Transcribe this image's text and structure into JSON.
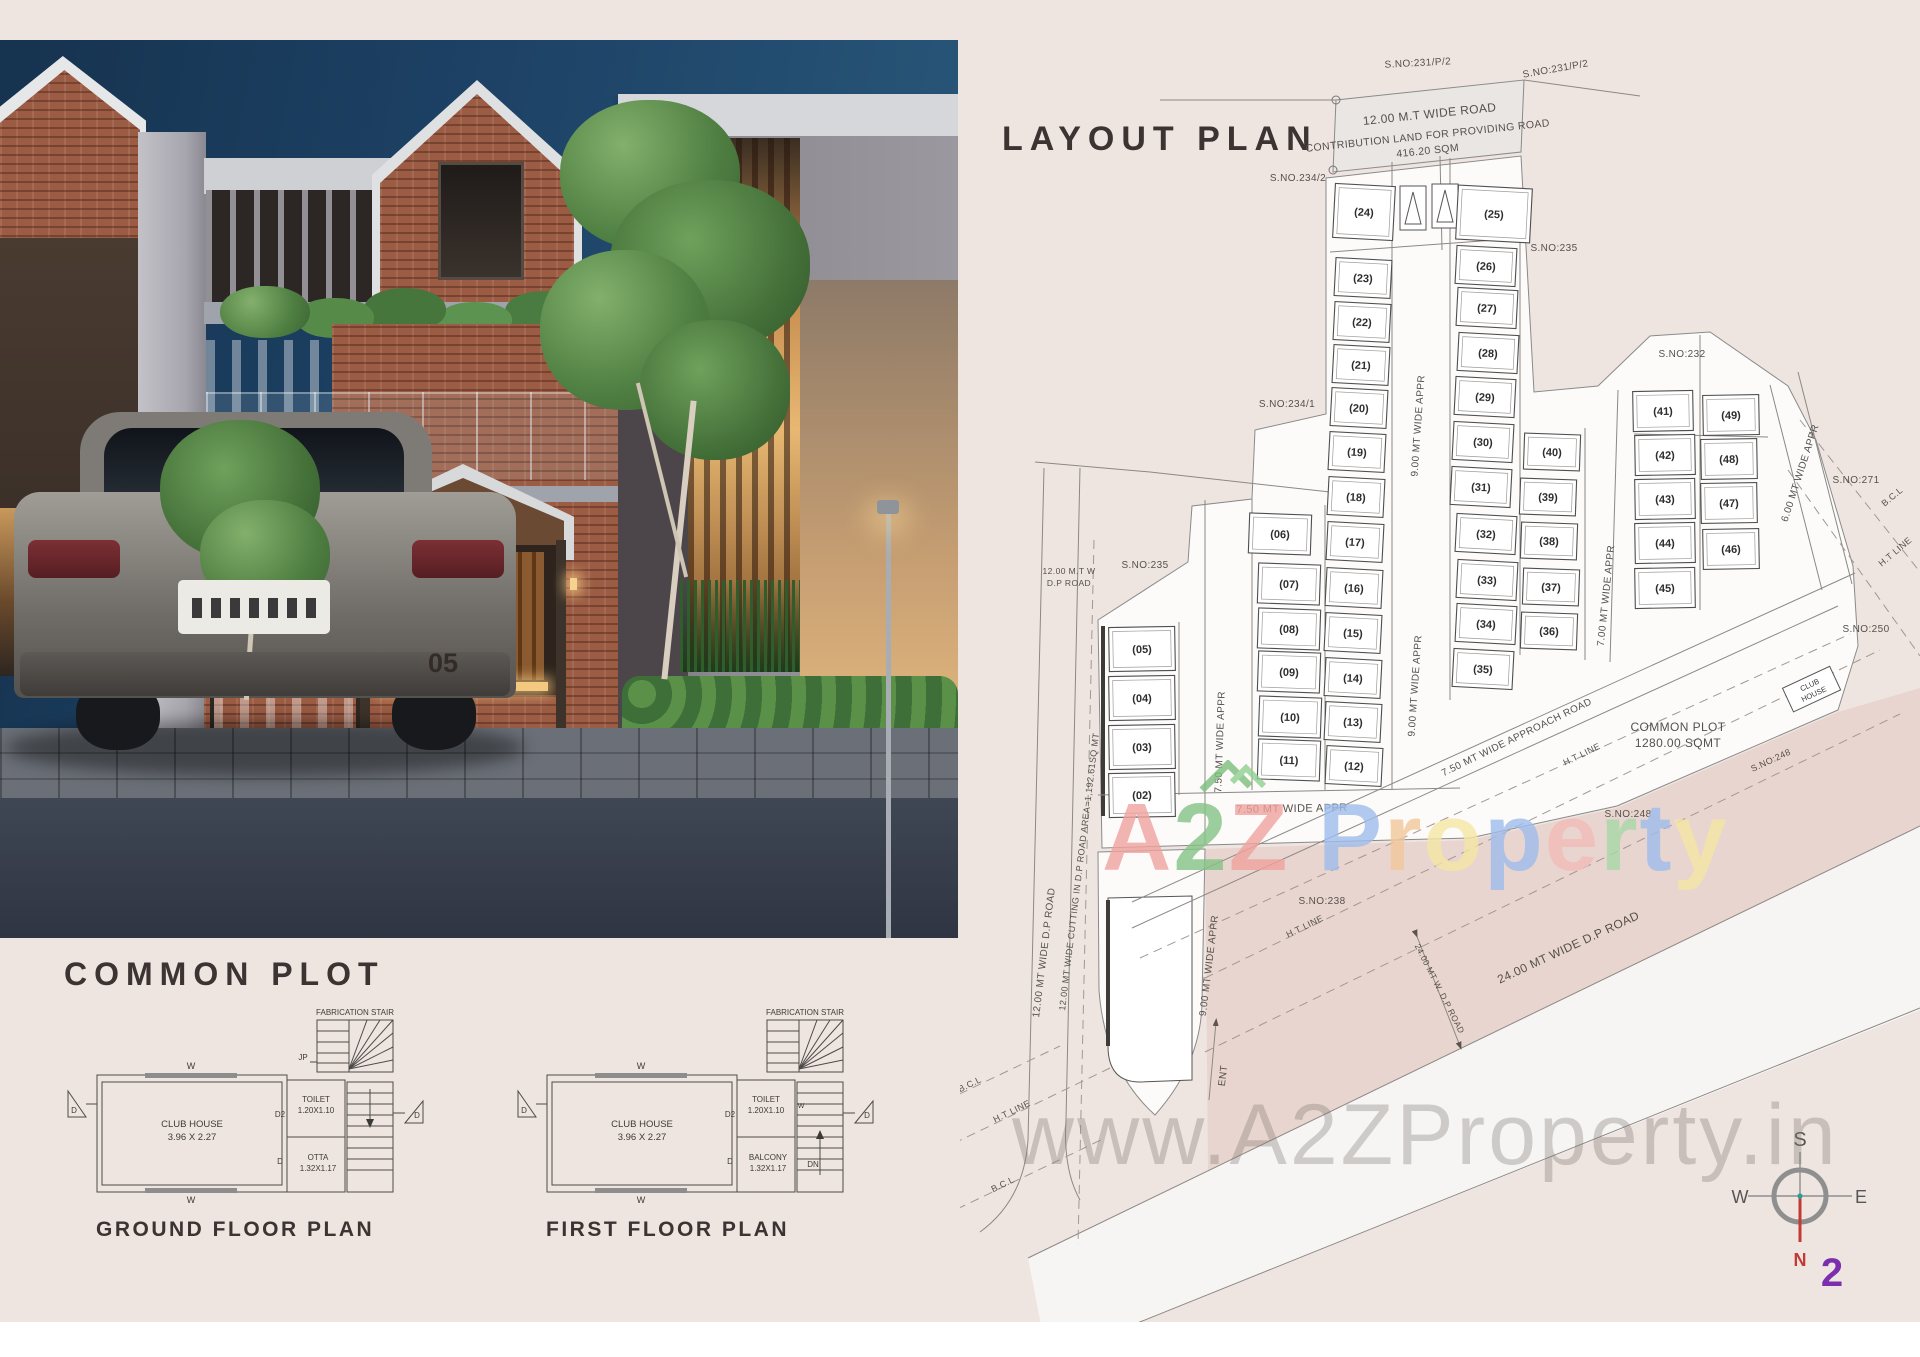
{
  "page": {
    "watermark_letters": [
      {
        "ch": "A",
        "color": "#f0a39e"
      },
      {
        "ch": "2",
        "color": "#85c487"
      },
      {
        "ch": "Z",
        "color": "#f0a39e"
      },
      {
        "ch": " ",
        "color": "#ffffff"
      },
      {
        "ch": "P",
        "color": "#9fbdec"
      },
      {
        "ch": "r",
        "color": "#f2c79b"
      },
      {
        "ch": "o",
        "color": "#f5e6a4"
      },
      {
        "ch": "p",
        "color": "#9fbdec"
      },
      {
        "ch": "e",
        "color": "#f2bdb8"
      },
      {
        "ch": "r",
        "color": "#a8d8a8"
      },
      {
        "ch": "t",
        "color": "#9fbdec"
      },
      {
        "ch": "y",
        "color": "#f5e6a4"
      }
    ],
    "watermark_url": "www.A2ZProperty.in"
  },
  "photo": {
    "house_number": "05"
  },
  "common_plot": {
    "title": "COMMON PLOT",
    "ground": {
      "caption": "GROUND FLOOR PLAN",
      "stair": "FABRICATION STAIR",
      "jp": "JP",
      "w": "W",
      "d": "D",
      "d2": "D2",
      "room": "CLUB HOUSE",
      "room_dim": "3.96 X 2.27",
      "toilet": "TOILET",
      "toilet_dim": "1.20X1.10",
      "aux": "OTTA",
      "aux_dim": "1.32X1.17"
    },
    "first": {
      "caption": "FIRST FLOOR PLAN",
      "stair": "FABRICATION STAIR",
      "w": "W",
      "w_side": "W",
      "d": "D",
      "d2": "D2",
      "room": "CLUB HOUSE",
      "room_dim": "3.96 X 2.27",
      "toilet": "TOILET",
      "toilet_dim": "1.20X1.10",
      "aux": "BALCONY",
      "aux_dim": "1.32X1.17",
      "dn": "DN"
    }
  },
  "layout_plan": {
    "title": "LAYOUT PLAN",
    "club_house_line1": "CLUB",
    "club_house_line2": "HOUSE",
    "compass": {
      "s": "S",
      "w": "W",
      "e": "E",
      "n": "N",
      "num": "2"
    },
    "plots": [
      {
        "n": "(02)",
        "x": 1142,
        "y": 795,
        "w": 66,
        "h": 44,
        "r": -1
      },
      {
        "n": "(03)",
        "x": 1142,
        "y": 747,
        "w": 66,
        "h": 44,
        "r": -1
      },
      {
        "n": "(04)",
        "x": 1142,
        "y": 698,
        "w": 66,
        "h": 44,
        "r": -1
      },
      {
        "n": "(05)",
        "x": 1142,
        "y": 649,
        "w": 66,
        "h": 44,
        "r": -1
      },
      {
        "n": "(06)",
        "x": 1280,
        "y": 534,
        "w": 62,
        "h": 40,
        "r": 2
      },
      {
        "n": "(07)",
        "x": 1289,
        "y": 584,
        "w": 62,
        "h": 40,
        "r": 2
      },
      {
        "n": "(08)",
        "x": 1289,
        "y": 629,
        "w": 62,
        "h": 40,
        "r": 2
      },
      {
        "n": "(09)",
        "x": 1289,
        "y": 672,
        "w": 62,
        "h": 40,
        "r": 2
      },
      {
        "n": "(10)",
        "x": 1290,
        "y": 717,
        "w": 62,
        "h": 40,
        "r": 2
      },
      {
        "n": "(11)",
        "x": 1289,
        "y": 760,
        "w": 62,
        "h": 40,
        "r": 2
      },
      {
        "n": "(12)",
        "x": 1354,
        "y": 766,
        "w": 56,
        "h": 38,
        "r": 3
      },
      {
        "n": "(13)",
        "x": 1353,
        "y": 722,
        "w": 56,
        "h": 38,
        "r": 3
      },
      {
        "n": "(14)",
        "x": 1353,
        "y": 678,
        "w": 56,
        "h": 38,
        "r": 3
      },
      {
        "n": "(15)",
        "x": 1353,
        "y": 633,
        "w": 56,
        "h": 38,
        "r": 3
      },
      {
        "n": "(16)",
        "x": 1354,
        "y": 588,
        "w": 56,
        "h": 38,
        "r": 3
      },
      {
        "n": "(17)",
        "x": 1355,
        "y": 542,
        "w": 56,
        "h": 38,
        "r": 3
      },
      {
        "n": "(18)",
        "x": 1356,
        "y": 497,
        "w": 56,
        "h": 38,
        "r": 3
      },
      {
        "n": "(19)",
        "x": 1357,
        "y": 452,
        "w": 56,
        "h": 38,
        "r": 3
      },
      {
        "n": "(20)",
        "x": 1359,
        "y": 408,
        "w": 56,
        "h": 38,
        "r": 3
      },
      {
        "n": "(21)",
        "x": 1361,
        "y": 365,
        "w": 56,
        "h": 38,
        "r": 3
      },
      {
        "n": "(22)",
        "x": 1362,
        "y": 322,
        "w": 56,
        "h": 38,
        "r": 3
      },
      {
        "n": "(23)",
        "x": 1363,
        "y": 278,
        "w": 56,
        "h": 38,
        "r": 3
      },
      {
        "n": "(24)",
        "x": 1364,
        "y": 212,
        "w": 60,
        "h": 54,
        "r": 3
      },
      {
        "n": "(25)",
        "x": 1494,
        "y": 214,
        "w": 74,
        "h": 54,
        "r": 3
      },
      {
        "n": "(26)",
        "x": 1486,
        "y": 266,
        "w": 60,
        "h": 38,
        "r": 3
      },
      {
        "n": "(27)",
        "x": 1487,
        "y": 308,
        "w": 60,
        "h": 38,
        "r": 3
      },
      {
        "n": "(28)",
        "x": 1488,
        "y": 353,
        "w": 60,
        "h": 38,
        "r": 3
      },
      {
        "n": "(29)",
        "x": 1485,
        "y": 397,
        "w": 60,
        "h": 38,
        "r": 3
      },
      {
        "n": "(30)",
        "x": 1483,
        "y": 442,
        "w": 60,
        "h": 38,
        "r": 3
      },
      {
        "n": "(31)",
        "x": 1481,
        "y": 487,
        "w": 60,
        "h": 38,
        "r": 3
      },
      {
        "n": "(32)",
        "x": 1486,
        "y": 534,
        "w": 60,
        "h": 38,
        "r": 3
      },
      {
        "n": "(33)",
        "x": 1487,
        "y": 580,
        "w": 60,
        "h": 38,
        "r": 3
      },
      {
        "n": "(34)",
        "x": 1486,
        "y": 624,
        "w": 60,
        "h": 38,
        "r": 3
      },
      {
        "n": "(35)",
        "x": 1483,
        "y": 669,
        "w": 60,
        "h": 38,
        "r": 3
      },
      {
        "n": "(36)",
        "x": 1549,
        "y": 631,
        "w": 56,
        "h": 36,
        "r": 2
      },
      {
        "n": "(37)",
        "x": 1551,
        "y": 587,
        "w": 56,
        "h": 36,
        "r": 2
      },
      {
        "n": "(38)",
        "x": 1549,
        "y": 541,
        "w": 56,
        "h": 36,
        "r": 2
      },
      {
        "n": "(39)",
        "x": 1548,
        "y": 497,
        "w": 56,
        "h": 36,
        "r": 2
      },
      {
        "n": "(40)",
        "x": 1552,
        "y": 452,
        "w": 56,
        "h": 36,
        "r": 2
      },
      {
        "n": "(41)",
        "x": 1663,
        "y": 411,
        "w": 60,
        "h": 40,
        "r": -1
      },
      {
        "n": "(42)",
        "x": 1665,
        "y": 455,
        "w": 60,
        "h": 40,
        "r": -1
      },
      {
        "n": "(43)",
        "x": 1665,
        "y": 499,
        "w": 60,
        "h": 40,
        "r": -1
      },
      {
        "n": "(44)",
        "x": 1665,
        "y": 543,
        "w": 60,
        "h": 40,
        "r": -1
      },
      {
        "n": "(45)",
        "x": 1665,
        "y": 588,
        "w": 60,
        "h": 40,
        "r": -1
      },
      {
        "n": "(46)",
        "x": 1731,
        "y": 549,
        "w": 56,
        "h": 40,
        "r": -1
      },
      {
        "n": "(47)",
        "x": 1729,
        "y": 503,
        "w": 56,
        "h": 40,
        "r": -1
      },
      {
        "n": "(48)",
        "x": 1729,
        "y": 459,
        "w": 56,
        "h": 40,
        "r": -1
      },
      {
        "n": "(49)",
        "x": 1731,
        "y": 415,
        "w": 56,
        "h": 40,
        "r": -1
      }
    ],
    "labels": [
      {
        "t": "S.NO:231/P/2",
        "x": 1418,
        "y": 66,
        "r": -3,
        "fs": 10
      },
      {
        "t": "S.NO:231/P/2",
        "x": 1556,
        "y": 72,
        "r": -10,
        "fs": 10
      },
      {
        "t": "12.00 M.T WIDE ROAD",
        "x": 1430,
        "y": 118,
        "r": -6,
        "fs": 12
      },
      {
        "t": "CONTRIBUTION LAND FOR PROVIDING ROAD",
        "x": 1428,
        "y": 139,
        "r": -6,
        "fs": 10.5
      },
      {
        "t": "416.20 SQM",
        "x": 1428,
        "y": 154,
        "r": -6,
        "fs": 10.5
      },
      {
        "t": "S.NO.234/2",
        "x": 1298,
        "y": 181,
        "r": 0,
        "fs": 10
      },
      {
        "t": "S.NO:235",
        "x": 1554,
        "y": 251,
        "r": 0,
        "fs": 10
      },
      {
        "t": "S.NO:232",
        "x": 1682,
        "y": 357,
        "r": 0,
        "fs": 10
      },
      {
        "t": "S.NO:234/1",
        "x": 1287,
        "y": 407,
        "r": 0,
        "fs": 10
      },
      {
        "t": "S.NO:235",
        "x": 1145,
        "y": 568,
        "r": 0,
        "fs": 10
      },
      {
        "t": "S.NO:271",
        "x": 1856,
        "y": 483,
        "r": 0,
        "fs": 10
      },
      {
        "t": "S.NO:250",
        "x": 1866,
        "y": 632,
        "r": 0,
        "fs": 10
      },
      {
        "t": "S.NO:248",
        "x": 1628,
        "y": 817,
        "r": 0,
        "fs": 10
      },
      {
        "t": "S.NO:248",
        "x": 1772,
        "y": 763,
        "r": -25,
        "fs": 9
      },
      {
        "t": "S.NO:238",
        "x": 1322,
        "y": 904,
        "r": 0,
        "fs": 10
      },
      {
        "t": "9.00 MT WIDE APPR",
        "x": 1421,
        "y": 426,
        "r": -86,
        "fs": 10
      },
      {
        "t": "9.00 MT WIDE APPR",
        "x": 1418,
        "y": 686,
        "r": -86,
        "fs": 10
      },
      {
        "t": "7.50 MT WIDE APPR",
        "x": 1223,
        "y": 742,
        "r": -88,
        "fs": 10
      },
      {
        "t": "7.50 MT WIDE APPR",
        "x": 1292,
        "y": 812,
        "r": -1,
        "fs": 11
      },
      {
        "t": "7.00 MT WIDE APPR",
        "x": 1609,
        "y": 596,
        "r": -84,
        "fs": 10
      },
      {
        "t": "6.00 MT WIDE APPR",
        "x": 1803,
        "y": 474,
        "r": -72,
        "fs": 10
      },
      {
        "t": "7.50 MT WIDE APPROACH ROAD",
        "x": 1518,
        "y": 740,
        "r": -26,
        "fs": 10
      },
      {
        "t": "H.T LINE",
        "x": 1583,
        "y": 757,
        "r": -26,
        "fs": 9
      },
      {
        "t": "H.T LINE",
        "x": 1897,
        "y": 554,
        "r": -40,
        "fs": 9
      },
      {
        "t": "H.T LINE",
        "x": 1306,
        "y": 929,
        "r": -26,
        "fs": 9
      },
      {
        "t": "H.T LINE",
        "x": 1013,
        "y": 1114,
        "r": -26,
        "fs": 9
      },
      {
        "t": "B.C.L",
        "x": 1894,
        "y": 499,
        "r": -40,
        "fs": 9
      },
      {
        "t": "B.C.L",
        "x": 971,
        "y": 1087,
        "r": -26,
        "fs": 9
      },
      {
        "t": "B.C.L",
        "x": 1004,
        "y": 1187,
        "r": -26,
        "fs": 9
      },
      {
        "t": "12.00 M.T W",
        "x": 1069,
        "y": 574,
        "r": 0,
        "fs": 8.5
      },
      {
        "t": "D.P ROAD",
        "x": 1069,
        "y": 586,
        "r": 0,
        "fs": 8.5
      },
      {
        "t": "12.00 MT WIDE D.P ROAD",
        "x": 1047,
        "y": 953,
        "r": -83,
        "fs": 10
      },
      {
        "t": "12.00 MT WIDE CUTTING IN D.P ROAD AREA=1,192.61SQ MT",
        "x": 1082,
        "y": 872,
        "r": -83,
        "fs": 9
      },
      {
        "t": "9.00 MT WIDE APPR",
        "x": 1212,
        "y": 966,
        "r": -83,
        "fs": 10
      },
      {
        "t": "ENT",
        "x": 1226,
        "y": 1076,
        "r": -83,
        "fs": 10
      },
      {
        "t": "24.00 MT WIDE D.P ROAD",
        "x": 1570,
        "y": 951,
        "r": -25,
        "fs": 12
      },
      {
        "t": "24.00 MT W. D.P ROAD",
        "x": 1437,
        "y": 990,
        "r": 63,
        "fs": 8.5
      },
      {
        "t": "COMMON PLOT",
        "x": 1678,
        "y": 731,
        "r": 0,
        "fs": 12
      },
      {
        "t": "1280.00 SQMT",
        "x": 1678,
        "y": 747,
        "r": 0,
        "fs": 12
      }
    ]
  }
}
